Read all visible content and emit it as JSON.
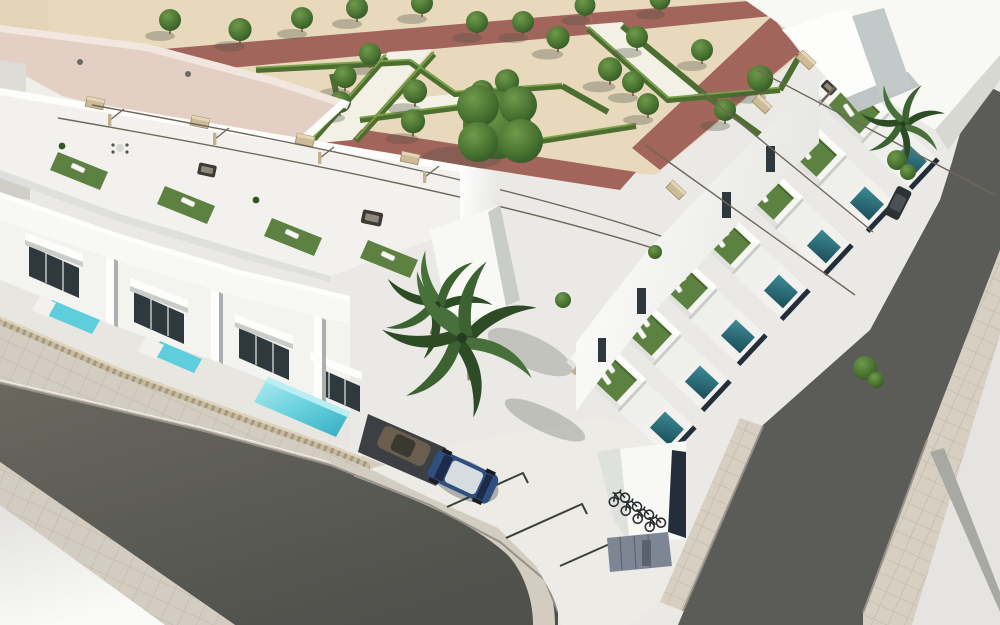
{
  "scene": {
    "title": "Aerial 3D architectural rendering: modern white townhouse complex with rooftop terraces, private pools, landscaped park and corner streets",
    "description": "Bird's-eye CGI view of a corner block of two-storey white villas. Each unit has a roof terrace with artificial turf, sun loungers, rattan furniture and slim pergolas. Street-side yards hold small turquoise plunge pools behind beige slatted fences; the right-hand row has dark teal pools facing the street behind shadowed walls. Above, a formal park with clipped hedge chevrons, ornamental trees, red-brown and white walkways. Asphalt streets with tiled sidewalks wrap the corner parking court containing a blue hatchback, a carport with an olive car, marked bays, a bicycle bay and grey storage doors. Palm trees accent the courtyard.",
    "time_of_day": "bright midday sun",
    "visible_text": "none"
  },
  "objects": {
    "park": "geometric parterre garden with hedge chevrons, trees, red and white paths",
    "left_row": "street-facing townhouses with roof terraces, turquoise pools, slatted fences",
    "right_row": "townhouses along right street with dark teal pools and pergola terraces",
    "corner": "parking court with marked bays, carport, blue hatchback, bike bay, storage doors",
    "landmark_building": "large flat terracotta-roofed building, upper left",
    "vehicles": [
      "dark blue hatchback",
      "olive car under carport",
      "dark car on right street"
    ],
    "vegetation": [
      "palm trees",
      "ornamental park trees",
      "clipped hedges",
      "rooftop turf"
    ]
  },
  "colors": {
    "sand": "#e8d9bd",
    "path_red": "#a2655c",
    "path_white": "#f3f0e6",
    "hedge": "#4e6e31",
    "hedge_light": "#7aa449",
    "tree": "#3f6b33",
    "turf": "#5c8140",
    "wall_white": "#f7f7f4",
    "roof_terracotta": "#e3cfc4",
    "glass": "#2f383c",
    "pool_bright": "#5ecddc",
    "pool_dark": "#2e737e",
    "fence": "#c6bba2",
    "asphalt": "#5b5b57",
    "sidewalk": "#d3ccc0",
    "pavement": "#ebe9e5",
    "navy_wall": "#242e3a",
    "car_blue": "#2f4f7e",
    "storage": "#7e8695",
    "pergola": "#c2b18f"
  }
}
